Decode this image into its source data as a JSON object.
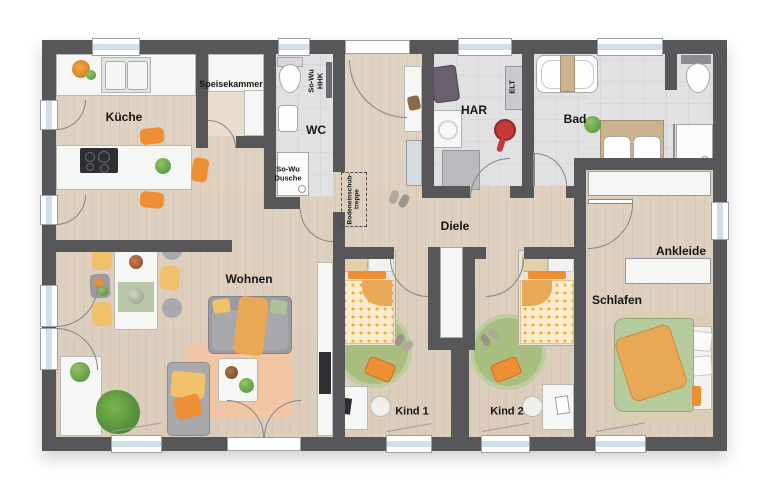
{
  "rooms": {
    "kueche": "Küche",
    "speisekammer": "Speisekammer",
    "wc": "WC",
    "so_wu_hhk": "So-Wu\nHHK",
    "so_wu_dusche": "So-Wu\nDusche",
    "har": "HAR",
    "elt": "ELT",
    "bad": "Bad",
    "diele": "Diele",
    "treppe": "Bodeneinschub-\ntreppe",
    "wohnen": "Wohnen",
    "kind1": "Kind 1",
    "kind2": "Kind 2",
    "schlafen": "Schlafen",
    "ankleide": "Ankleide"
  },
  "colors": {
    "wall": "#57575a",
    "floorTile": "#e1e1e4",
    "accentOrange": "#ee8f35",
    "accentYellow": "#f0c06a",
    "accentGreen": "#a9bd7f",
    "rugPeach": "#f2c5a4",
    "rugBeige": "#d9cdb4",
    "sofaGrey": "#9b9ba0",
    "white": "#f6f6f4",
    "glass": "#cfe0ea",
    "arc": "#85858a",
    "duvet": "#faeccb",
    "duvetDot": "#f2a93b",
    "bedGreen": "#b5cb9d",
    "blanketOrange": "#e8a855",
    "woodCounter": "#cbb392",
    "dark": "#2e2e33"
  }
}
